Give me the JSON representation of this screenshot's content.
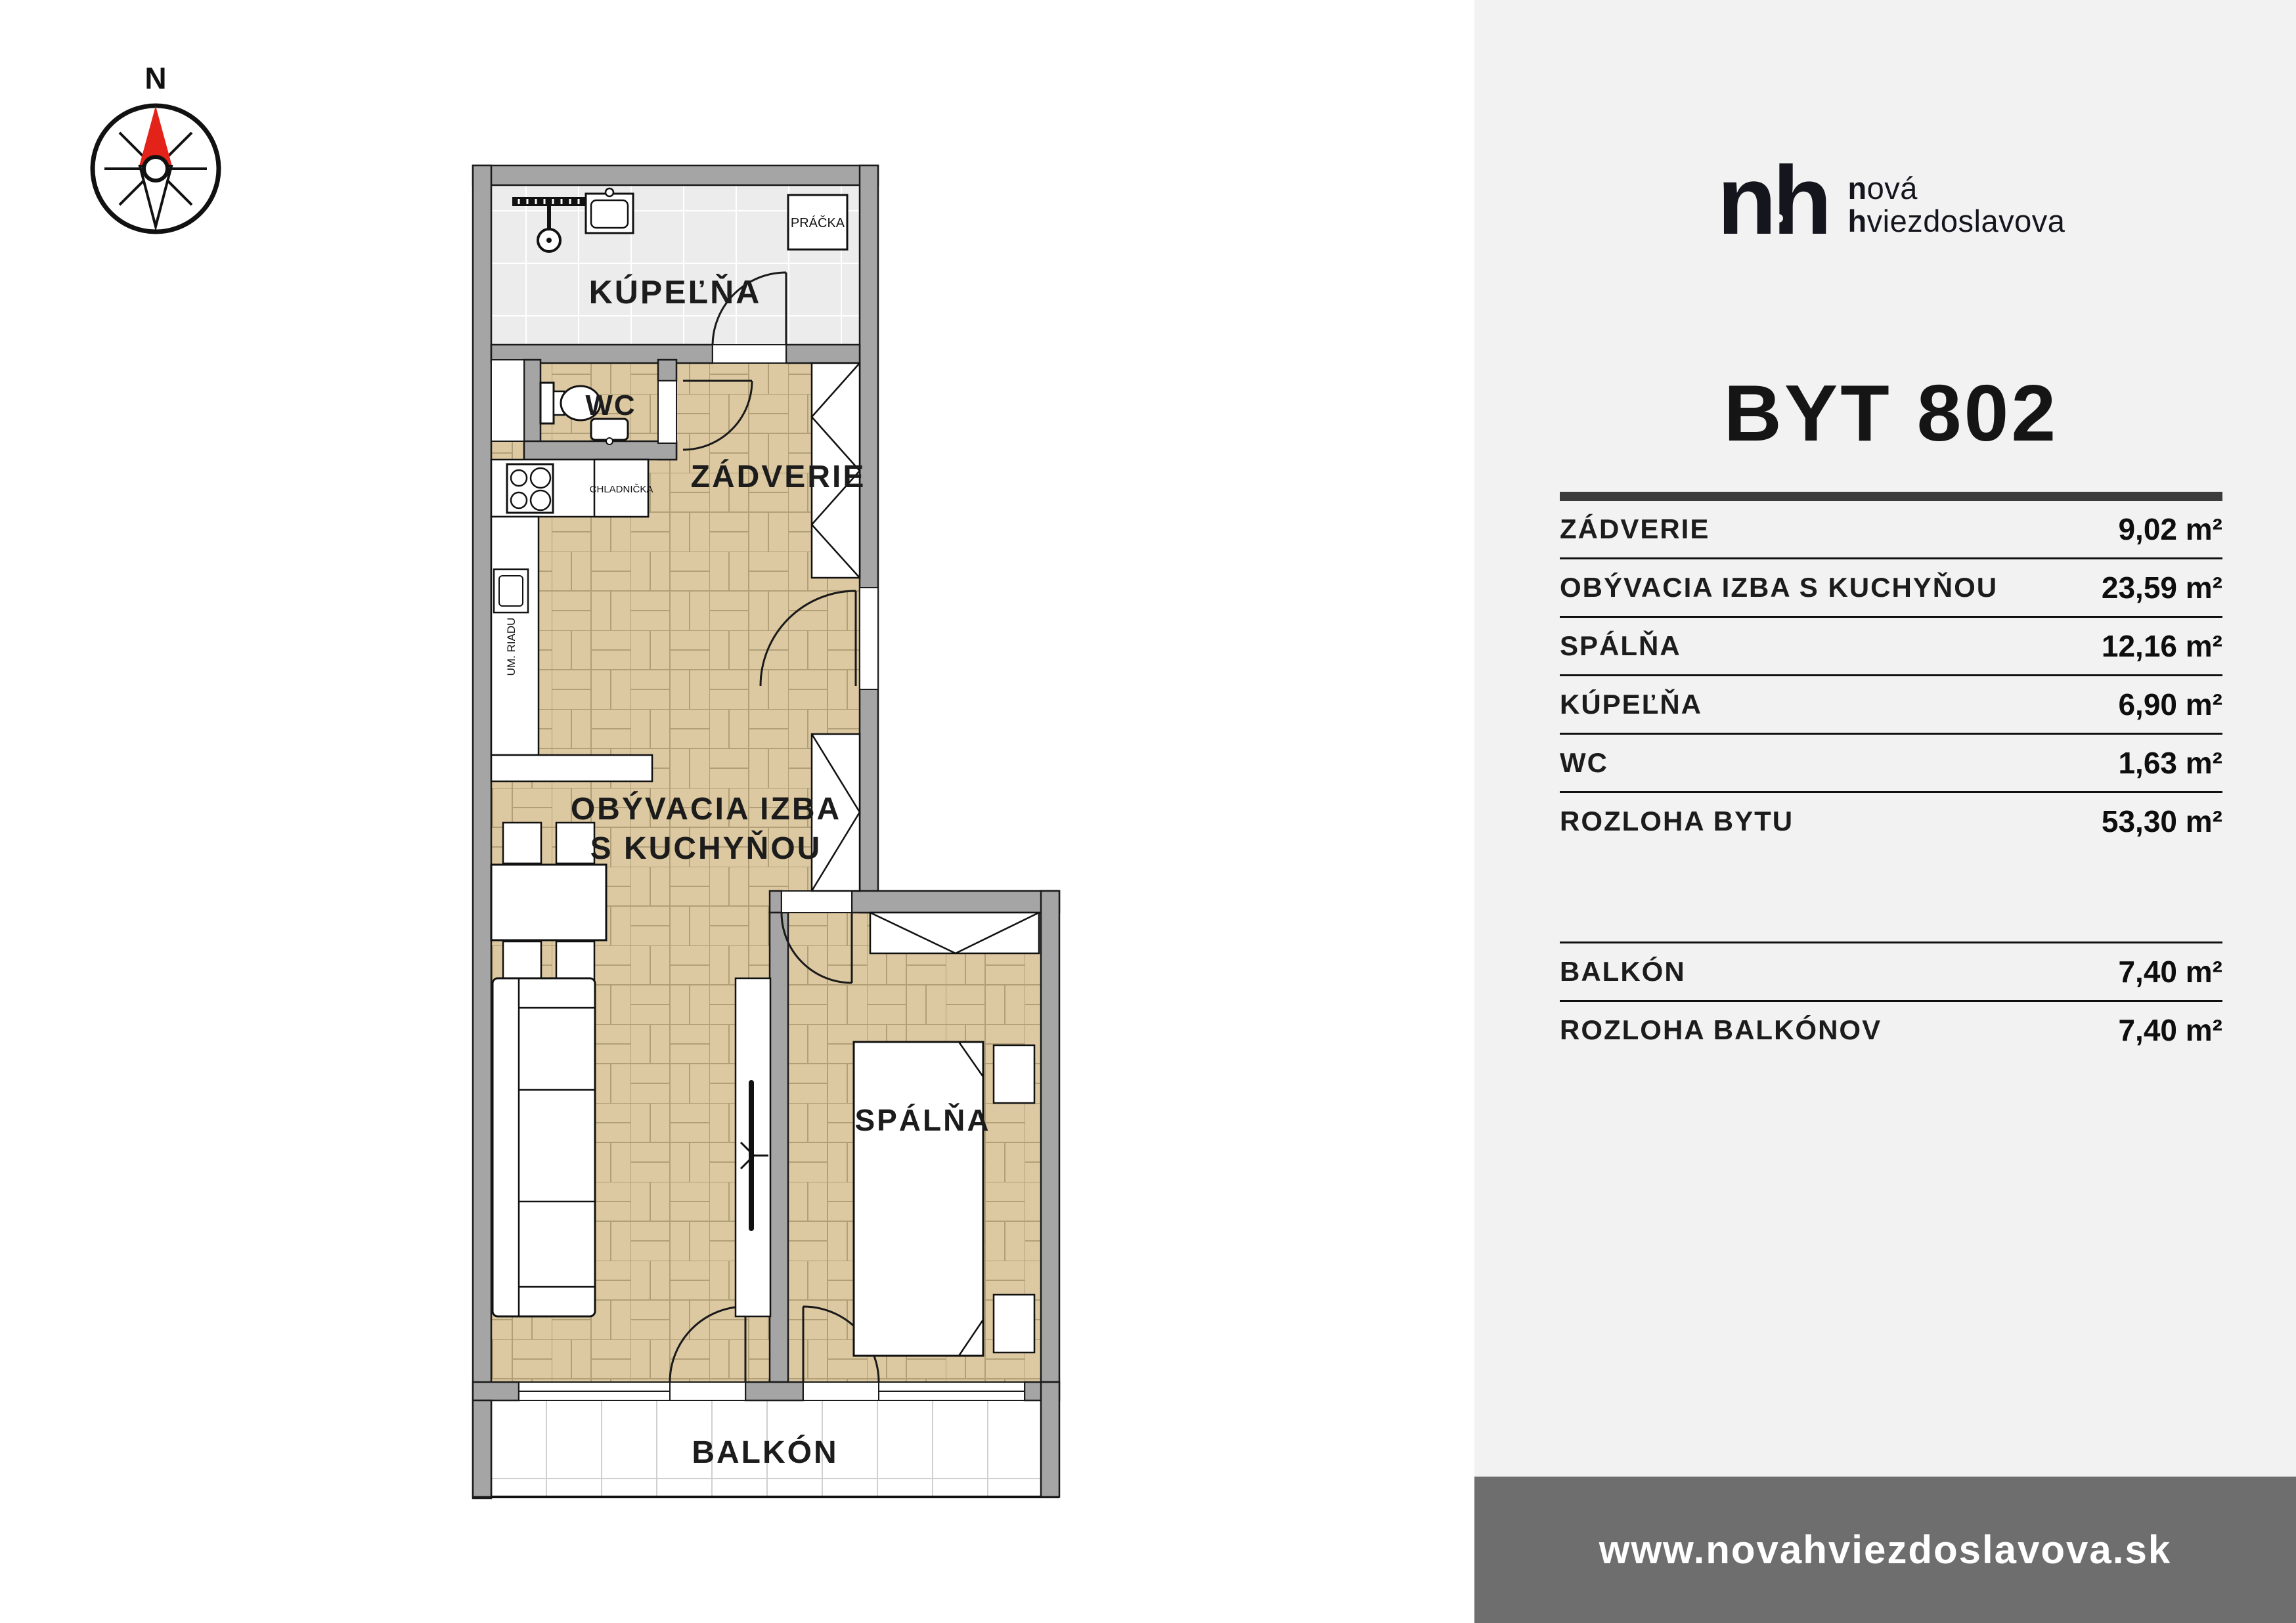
{
  "plan": {
    "compass": "N",
    "labels": {
      "bathroom": "KÚPEĽŇA",
      "wc": "WC",
      "hall": "ZÁDVERIE",
      "washer": "PRÁČKA",
      "fridge": "CHLADNIČKA",
      "dishwasher": "UM. RIADU",
      "living_line1": "OBÝVACIA IZBA",
      "living_line2": "S KUCHYŇOU",
      "bedroom": "SPÁLŇA",
      "balcony": "BALKÓN"
    }
  },
  "panel": {
    "logo": {
      "mark": "nh",
      "word1_bold": "n",
      "word1_rest": "ová",
      "word2_bold": "h",
      "word2_rest": "viezdoslavova"
    },
    "title": "BYT 802",
    "table": {
      "rows": [
        {
          "label": "ZÁDVERIE",
          "value": "9,02 m²"
        },
        {
          "label": "OBÝVACIA IZBA S KUCHYŇOU",
          "value": "23,59 m²"
        },
        {
          "label": "SPÁLŇA",
          "value": "12,16 m²"
        },
        {
          "label": "KÚPEĽŇA",
          "value": "6,90 m²"
        },
        {
          "label": "WC",
          "value": "1,63 m²"
        },
        {
          "label": "ROZLOHA BYTU",
          "value": "53,30 m²"
        }
      ],
      "balcony_rows": [
        {
          "label": "BALKÓN",
          "value": "7,40 m²"
        },
        {
          "label": "ROZLOHA BALKÓNOV",
          "value": "7,40 m²"
        }
      ]
    },
    "footer_url": "www.novahviezdoslavova.sk"
  },
  "colors": {
    "accent_red": "#e32219",
    "wall_gray": "#a5a5a5",
    "parquet": "#dcc9a2",
    "tile": "#ececec",
    "panel_bg": "#f2f2f2",
    "footer_bg": "#6e6e6e",
    "ink": "#1c1c1c"
  }
}
